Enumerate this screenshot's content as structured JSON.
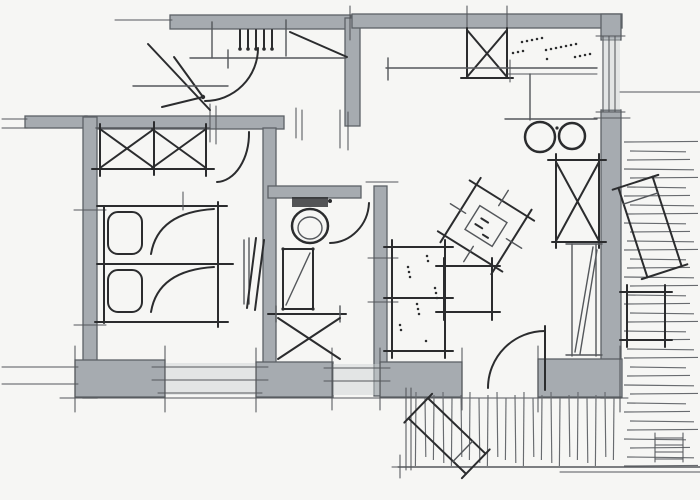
{
  "canvas": {
    "width": 700,
    "height": 500
  },
  "palette": {
    "paper": "#f6f6f4",
    "wall": "#a6abb0",
    "wall_edge": "#5c6166",
    "wall_light": "#ccd0d2",
    "ink": "#2b2c2e",
    "ink_soft": "#54575b",
    "hatch": "#686b6f"
  },
  "drawing": {
    "kind": "hand-drawn apartment floor plan sketch",
    "technique": "gray marker walls with freehand black ink linework",
    "rooms": [
      {
        "name": "entry-hall",
        "features": [
          "entry-door-swing",
          "coat-hooks",
          "door-triangle-symbol",
          "bench-rail"
        ]
      },
      {
        "name": "bedroom",
        "features": [
          "double-x-wardrobe",
          "twin-beds",
          "pillows",
          "bedside-radiator",
          "door-swing",
          "window"
        ]
      },
      {
        "name": "bathroom",
        "features": [
          "toilet",
          "shower-cabin",
          "vanity-x-cabinet",
          "door-swing",
          "window"
        ]
      },
      {
        "name": "kitchen",
        "features": [
          "appliance-x-box",
          "stippled-countertop",
          "base-cabinet",
          "double-sink-circles",
          "window"
        ]
      },
      {
        "name": "living-room",
        "features": [
          "stippled-sofa",
          "rotated-dining-table",
          "coffee-table",
          "x-wardrobe",
          "shelf-unit",
          "terrace-door-swing"
        ]
      },
      {
        "name": "right-terrace",
        "features": [
          "plank-hatching",
          "sun-lounger",
          "side-table"
        ]
      },
      {
        "name": "bottom-terrace",
        "features": [
          "plank-hatching",
          "sun-lounger",
          "ladder-mark"
        ]
      }
    ]
  }
}
